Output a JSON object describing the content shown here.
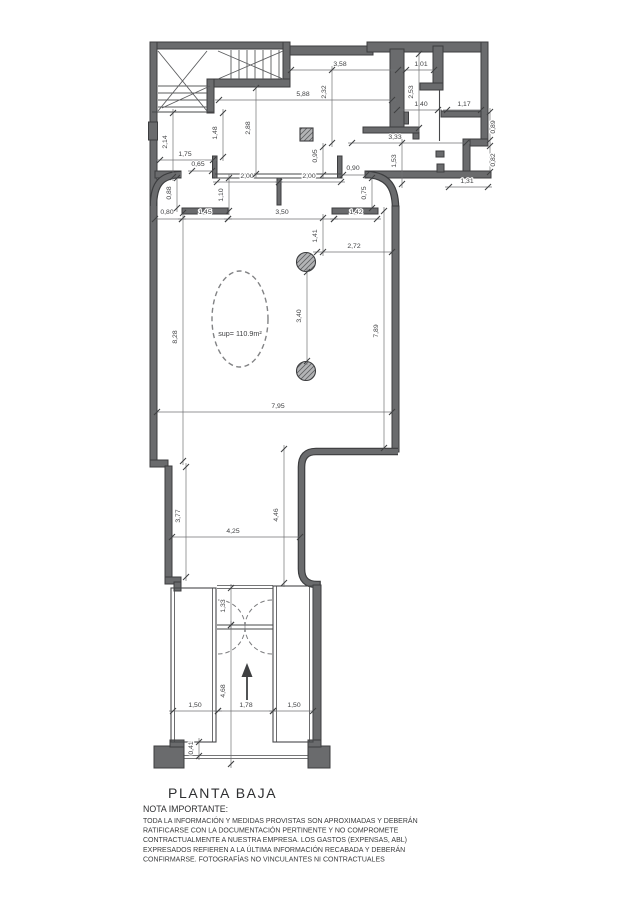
{
  "title": "PLANTA BAJA",
  "area_label": "sup= 110.9m²",
  "note": {
    "heading": "NOTA IMPORTANTE:",
    "lines": [
      "TODA LA INFORMACIÓN Y MEDIDAS PROVISTAS SON APROXIMADAS Y DEBERÁN",
      "RATIFICARSE CON LA DOCUMENTACIÓN PERTINENTE Y NO COMPROMETE",
      "CONTRACTUALMENTE A NUESTRA EMPRESA. LOS GASTOS (EXPENSAS, ABL)",
      "EXPRESADOS REFIEREN A LA ÚLTIMA INFORMACIÓN RECABADA Y DEBERÁN",
      "CONFIRMARSE. FOTOGRAFÍAS NO VINCULANTES NI CONTRACTUALES"
    ]
  },
  "colors": {
    "wall": "#6a6b6d",
    "wall_edge": "#3c3d3f",
    "dim_text": "#3e3f41",
    "background": "#ffffff"
  },
  "dimensions": [
    {
      "label": "3,58",
      "lx": 340,
      "ly": 66,
      "v": false,
      "x1": 291,
      "y1": 70,
      "x2": 398,
      "y2": 70
    },
    {
      "label": "1,01",
      "lx": 421,
      "ly": 66,
      "v": false,
      "x1": 406,
      "y1": 70,
      "x2": 434,
      "y2": 70
    },
    {
      "label": "5,88",
      "lx": 303,
      "ly": 96,
      "v": false,
      "x1": 219,
      "y1": 100,
      "x2": 392,
      "y2": 100
    },
    {
      "label": "1,40",
      "lx": 421,
      "ly": 106,
      "v": false,
      "x1": 397,
      "y1": 110,
      "x2": 438,
      "y2": 110
    },
    {
      "label": "1,17",
      "lx": 464,
      "ly": 106,
      "v": false,
      "x1": 447,
      "y1": 110,
      "x2": 481,
      "y2": 110
    },
    {
      "label": "3,33",
      "lx": 395,
      "ly": 139,
      "v": false,
      "x1": 352,
      "y1": 143,
      "x2": 466,
      "y2": 143
    },
    {
      "label": "1,31",
      "lx": 467,
      "ly": 183,
      "v": false,
      "x1": 449,
      "y1": 187,
      "x2": 488,
      "y2": 187
    },
    {
      "label": "1,75",
      "lx": 185,
      "ly": 156,
      "v": false,
      "x1": 160,
      "y1": 160,
      "x2": 213,
      "y2": 160
    },
    {
      "label": "0,65",
      "lx": 198,
      "ly": 166,
      "v": false,
      "x1": 192,
      "y1": 171,
      "x2": 212,
      "y2": 171
    },
    {
      "label": "2,00",
      "lx": 247,
      "ly": 178,
      "v": false,
      "x1": 217,
      "y1": 182,
      "x2": 279,
      "y2": 182
    },
    {
      "label": "2,00",
      "lx": 309,
      "ly": 178,
      "v": false,
      "x1": 279,
      "y1": 182,
      "x2": 341,
      "y2": 182
    },
    {
      "label": "0,90",
      "lx": 353,
      "ly": 170,
      "v": false,
      "x1": 343,
      "y1": 175,
      "x2": 366,
      "y2": 175
    },
    {
      "label": "0,80",
      "lx": 167,
      "ly": 214,
      "v": false,
      "x1": 155,
      "y1": 219,
      "x2": 182,
      "y2": 219
    },
    {
      "label": "1,45",
      "lx": 205,
      "ly": 214,
      "v": false,
      "x1": 182,
      "y1": 219,
      "x2": 228,
      "y2": 219
    },
    {
      "label": "3,50",
      "lx": 282,
      "ly": 214,
      "v": false,
      "x1": 228,
      "y1": 219,
      "x2": 334,
      "y2": 219
    },
    {
      "label": "1,42",
      "lx": 356,
      "ly": 214,
      "v": false,
      "x1": 334,
      "y1": 219,
      "x2": 377,
      "y2": 219
    },
    {
      "label": "2,72",
      "lx": 354,
      "ly": 248,
      "v": false,
      "x1": 317,
      "y1": 252,
      "x2": 392,
      "y2": 252
    },
    {
      "label": "7,95",
      "lx": 278,
      "ly": 408,
      "v": false,
      "x1": 157,
      "y1": 412,
      "x2": 392,
      "y2": 412
    },
    {
      "label": "4,25",
      "lx": 233,
      "ly": 533,
      "v": false,
      "x1": 172,
      "y1": 537,
      "x2": 300,
      "y2": 537
    },
    {
      "label": "1,50",
      "lx": 195,
      "ly": 707,
      "v": false,
      "x1": 173,
      "y1": 711,
      "x2": 218,
      "y2": 711
    },
    {
      "label": "1,78",
      "lx": 246,
      "ly": 707,
      "v": false,
      "x1": 218,
      "y1": 711,
      "x2": 273,
      "y2": 711
    },
    {
      "label": "1,50",
      "lx": 294,
      "ly": 707,
      "v": false,
      "x1": 273,
      "y1": 711,
      "x2": 313,
      "y2": 711
    },
    {
      "label": "2,32",
      "lx": 326,
      "ly": 92,
      "v": true,
      "x1": 332,
      "y1": 70,
      "x2": 332,
      "y2": 143
    },
    {
      "label": "2,53",
      "lx": 413,
      "ly": 92,
      "v": true,
      "x1": 419,
      "y1": 54,
      "x2": 419,
      "y2": 128
    },
    {
      "label": "2,88",
      "lx": 250,
      "ly": 128,
      "v": true,
      "x1": 256,
      "y1": 88,
      "x2": 256,
      "y2": 174
    },
    {
      "label": "1,48",
      "lx": 217,
      "ly": 133,
      "v": true,
      "x1": 223,
      "y1": 113,
      "x2": 223,
      "y2": 157
    },
    {
      "label": "2,14",
      "lx": 167,
      "ly": 142,
      "v": true,
      "x1": 173,
      "y1": 113,
      "x2": 173,
      "y2": 177
    },
    {
      "label": "0,95",
      "lx": 317,
      "ly": 156,
      "v": true,
      "x1": 323,
      "y1": 147,
      "x2": 323,
      "y2": 175
    },
    {
      "label": "1,53",
      "lx": 396,
      "ly": 161,
      "v": true,
      "x1": 402,
      "y1": 143,
      "x2": 402,
      "y2": 184
    },
    {
      "label": "0,89",
      "lx": 495,
      "ly": 127,
      "v": true,
      "x1": 490,
      "y1": 112,
      "x2": 490,
      "y2": 140
    },
    {
      "label": "0,82",
      "lx": 495,
      "ly": 160,
      "v": true,
      "x1": 490,
      "y1": 146,
      "x2": 490,
      "y2": 172
    },
    {
      "label": "0,88",
      "lx": 171,
      "ly": 193,
      "v": true,
      "x1": 177,
      "y1": 178,
      "x2": 177,
      "y2": 208
    },
    {
      "label": "1,10",
      "lx": 223,
      "ly": 195,
      "v": true,
      "x1": 229,
      "y1": 178,
      "x2": 229,
      "y2": 211
    },
    {
      "label": "0,75",
      "lx": 366,
      "ly": 193,
      "v": true,
      "x1": 372,
      "y1": 178,
      "x2": 372,
      "y2": 208
    },
    {
      "label": "1,41",
      "lx": 317,
      "ly": 236,
      "v": true,
      "x1": 323,
      "y1": 218,
      "x2": 323,
      "y2": 252
    },
    {
      "label": "8,28",
      "lx": 177,
      "ly": 337,
      "v": true,
      "x1": 183,
      "y1": 213,
      "x2": 183,
      "y2": 461
    },
    {
      "label": "3,40",
      "lx": 301,
      "ly": 316,
      "v": true,
      "x1": 307,
      "y1": 272,
      "x2": 307,
      "y2": 361
    },
    {
      "label": "7,89",
      "lx": 378,
      "ly": 331,
      "v": true,
      "x1": 384,
      "y1": 211,
      "x2": 384,
      "y2": 448
    },
    {
      "label": "3,77",
      "lx": 180,
      "ly": 516,
      "v": true,
      "x1": 186,
      "y1": 467,
      "x2": 186,
      "y2": 577
    },
    {
      "label": "4,46",
      "lx": 278,
      "ly": 515,
      "v": true,
      "x1": 284,
      "y1": 449,
      "x2": 284,
      "y2": 583
    },
    {
      "label": "1,33",
      "lx": 225,
      "ly": 606,
      "v": true,
      "x1": 231,
      "y1": 588,
      "x2": 231,
      "y2": 625
    },
    {
      "label": "4,68",
      "lx": 225,
      "ly": 691,
      "v": true,
      "x1": 231,
      "y1": 625,
      "x2": 231,
      "y2": 764
    },
    {
      "label": "0,41",
      "lx": 193,
      "ly": 748,
      "v": true,
      "x1": 199,
      "y1": 742,
      "x2": 199,
      "y2": 756
    }
  ]
}
